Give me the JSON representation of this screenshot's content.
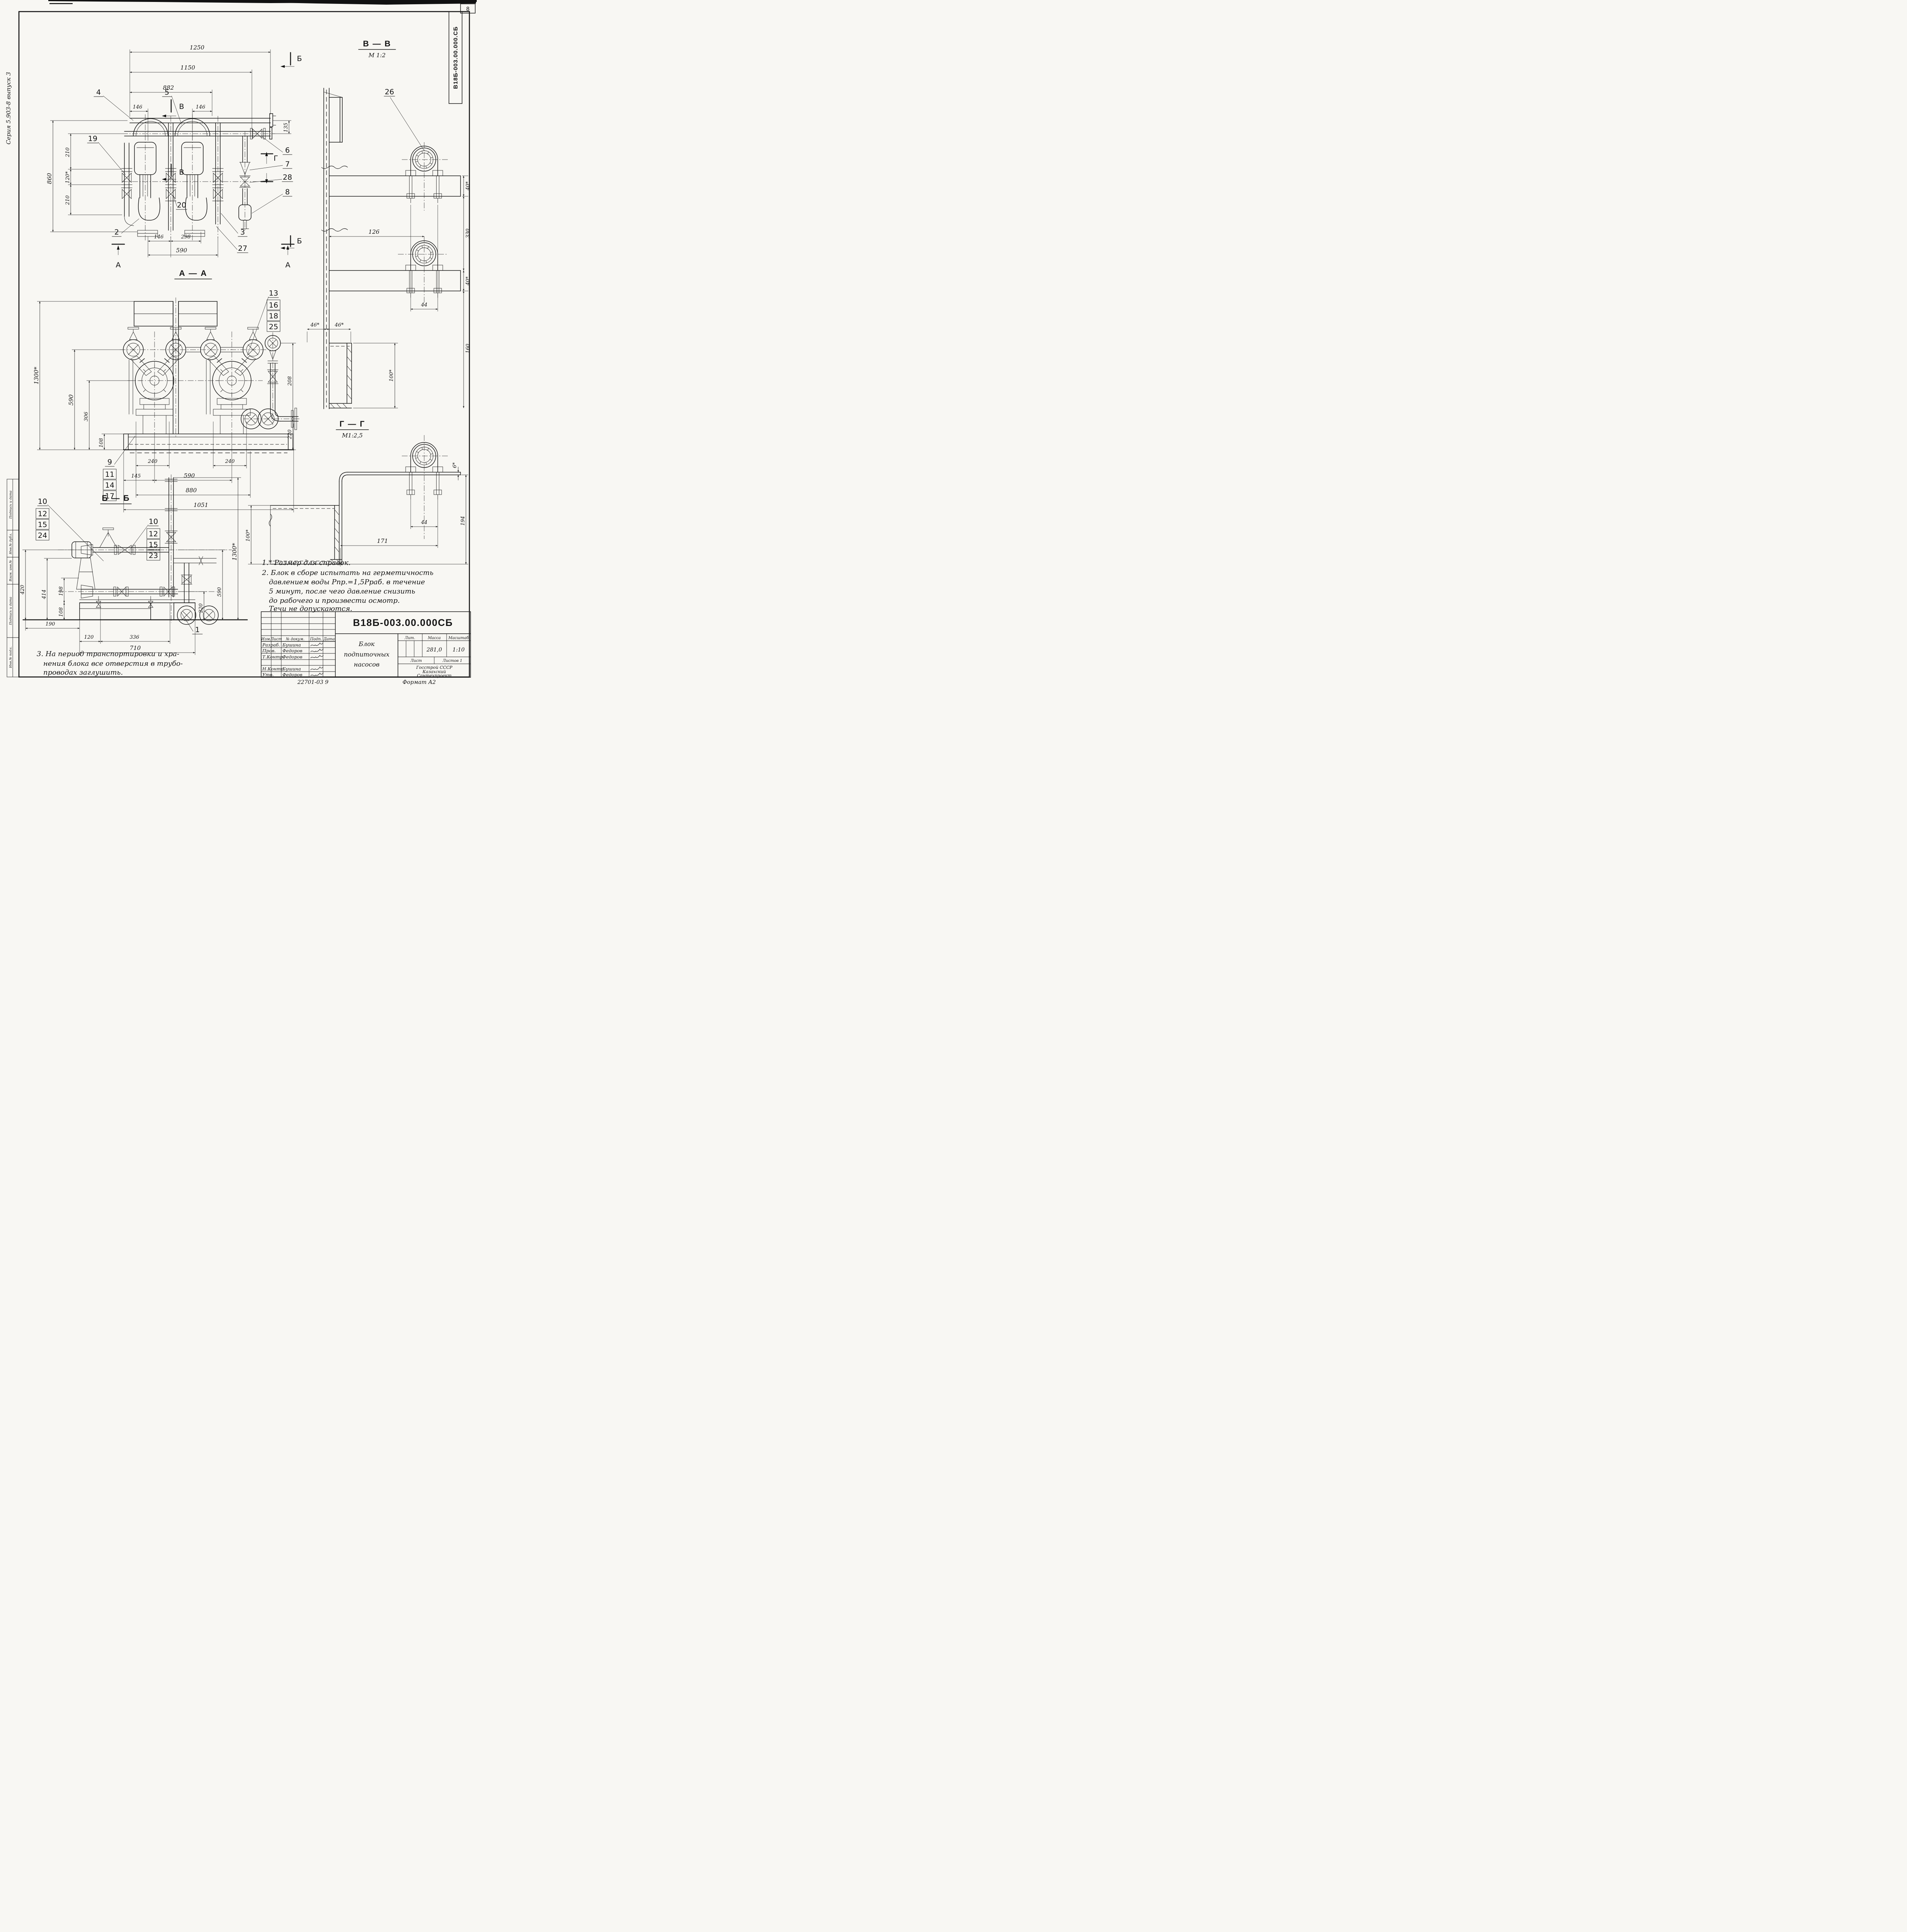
{
  "sheet": {
    "series_label": "Серия 5.903-8 выпуск 3",
    "corner_doc_label": "В18Б-003.00.000.СБ",
    "page_number": "8",
    "footer_code": "22701-03 9",
    "footer_format": "Формат А2",
    "margin_labels": [
      "Инв.№ подл.",
      "Подпись и дата",
      "Взам. инв.№",
      "Инв.№ дубл.",
      "Подпись и дата"
    ]
  },
  "front": {
    "markers": {
      "a": "А",
      "b": "Б",
      "v": "В",
      "g": "Г"
    },
    "dims": {
      "d1250": "1250",
      "d1150": "1150",
      "d882": "882",
      "d146l": "146",
      "d146r": "146",
      "d135": "135",
      "d860": "860",
      "d210t": "210",
      "d120": "120*",
      "d210b": "210",
      "d146b": "146",
      "d298": "298",
      "d590": "590"
    },
    "callouts": {
      "c2": "2",
      "c3": "3",
      "c4": "4",
      "c5": "5",
      "c6": "6",
      "c7": "7",
      "c8": "8",
      "c19": "19",
      "c20": "20",
      "c27": "27",
      "c28": "28"
    }
  },
  "vv": {
    "title": "В — В",
    "scale": "М 1:2",
    "callout": "26",
    "dims": {
      "d40t": "40*",
      "d126": "126",
      "d330": "330",
      "d40b": "40*",
      "d44": "44",
      "d46l": "46*",
      "d46r": "46*",
      "d160": "160",
      "d100": "100*"
    }
  },
  "aa": {
    "title": "А — А",
    "stack_r": [
      "13",
      "16",
      "18",
      "25"
    ],
    "stack_l": [
      "9",
      "11",
      "14",
      "17"
    ],
    "dims": {
      "d1300": "1300*",
      "d590": "590",
      "d306": "306",
      "d108": "108",
      "d208": "208",
      "d220": "220",
      "d240l": "240",
      "d240r": "240",
      "d145": "145",
      "d590b": "590",
      "d880": "880",
      "d1051": "1051"
    }
  },
  "gg": {
    "title": "Г — Г",
    "scale": "М1:2,5",
    "dims": {
      "d6": "6*",
      "d44": "44",
      "d171": "171",
      "d194": "194",
      "d100": "100*"
    }
  },
  "bb": {
    "title": "Б — Б",
    "callout": "1",
    "stack_l": [
      "10",
      "12",
      "15",
      "24"
    ],
    "stack_m": [
      "10",
      "12",
      "15",
      "23"
    ],
    "dims": {
      "d420": "420",
      "d414": "414",
      "d198": "198",
      "d108": "108",
      "d190": "190",
      "d120": "120",
      "d336": "336",
      "d710": "710",
      "d1300": "1300*",
      "d590": "590",
      "d220": "220"
    }
  },
  "notes": {
    "n1": "1.* Размер для справок.",
    "n2": [
      "2. Блок в сборе испытать на герметичность",
      "давлением воды Рпр.=1,5Рраб. в течение",
      "5 минут, после чего давление снизить",
      "до рабочего и произвести осмотр.",
      "Течи не допускаются."
    ],
    "n3": [
      "3. На период транспортировки и хра-",
      "нения блока все отверстия в трубо-",
      "проводах заглушить."
    ]
  },
  "tb": {
    "doc_number": "В18Б-003.00.000СБ",
    "title_lines": [
      "Блок",
      "подпиточных",
      "насосов"
    ],
    "cols": [
      "Изм.",
      "Лист",
      "№ докум.",
      "Подп.",
      "Дата"
    ],
    "roles": [
      "Разраб.",
      "Пров.",
      "Т.Контр.",
      "",
      "Н.Контр",
      "Утв."
    ],
    "names": [
      "Бушина",
      "Федоров",
      "Федоров",
      "",
      "Бушина",
      "Федоров"
    ],
    "lit_label": "Лит.",
    "mass_label": "Масса",
    "scale_label": "Масштаб",
    "mass_value": "281,0",
    "scale_value": "1:10",
    "sheet_label": "Лист",
    "sheets_label": "Листов 1",
    "org_lines": [
      "Госстрой СССР",
      "Казахский",
      "Сантехпроект"
    ]
  }
}
